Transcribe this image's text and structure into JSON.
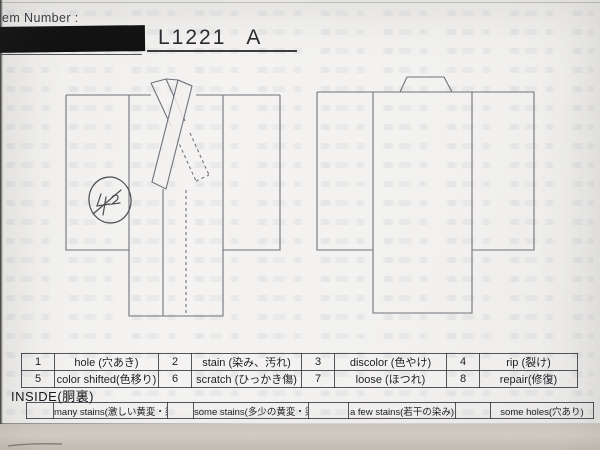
{
  "header": {
    "field_label": "em Number :",
    "item_number": "L1221",
    "item_suffix": "A"
  },
  "icons": {
    "front_diagram": "kimono-front-outline",
    "back_diagram": "kimono-back-outline",
    "annotation": "handwritten-circled-mark"
  },
  "legend": {
    "rows": [
      [
        {
          "num": "1",
          "label": "hole (穴あき)"
        },
        {
          "num": "2",
          "label": "stain (染み、汚れ)"
        },
        {
          "num": "3",
          "label": "discolor (色やけ)"
        },
        {
          "num": "4",
          "label": "rip (裂け)"
        }
      ],
      [
        {
          "num": "5",
          "label": "color shifted(色移り)"
        },
        {
          "num": "6",
          "label": "scratch (ひっかき傷)"
        },
        {
          "num": "7",
          "label": "loose (ほつれ)"
        },
        {
          "num": "8",
          "label": "repair(修復)"
        }
      ]
    ]
  },
  "inside": {
    "title": "INSIDE(胴裏)",
    "options": [
      {
        "label": "many stains(激しい黄変・染み)"
      },
      {
        "label": "some stains(多少の黄変・染み)"
      },
      {
        "label": "a few stains(若干の染み)"
      },
      {
        "label": "some holes(穴あり)"
      }
    ]
  },
  "colors": {
    "paper": "#f2f1ef",
    "redaction_bar": "#121212",
    "line": "#71717c",
    "ink": "#1d1d24"
  }
}
